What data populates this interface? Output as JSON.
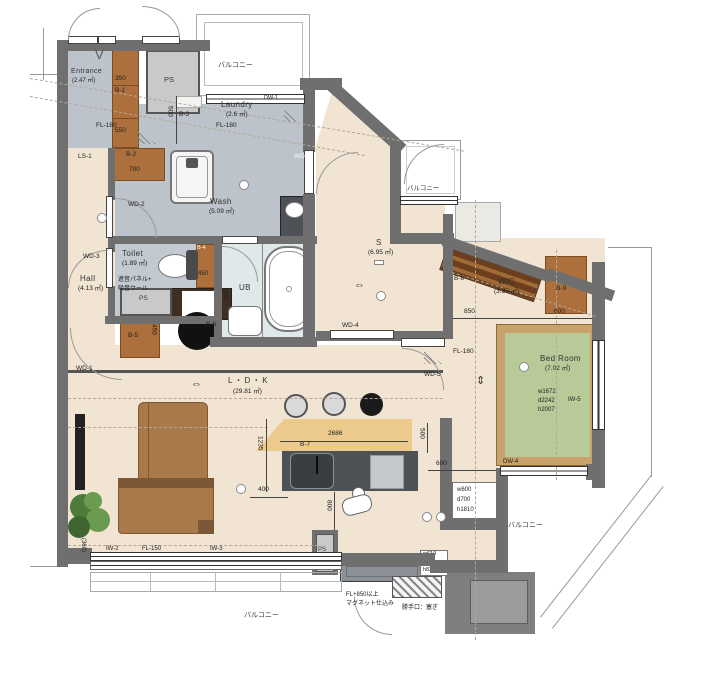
{
  "colors": {
    "wall": "#6f6f6f",
    "floor_wet": "#bcc3cb",
    "floor_main": "#f2e4d3",
    "floor_toilet": "#c2c9d0",
    "ub_floor": "#dfe9ea",
    "cabinet": "#ad6f3b",
    "cabinet_dark": "#6b3f1d",
    "bed_green": "#b7ca98",
    "bed_frame": "#c8a16b",
    "counter_wood": "#ecca8b",
    "kitchen_dark": "#4e5256",
    "sofa_brown": "#a9794a",
    "ps_gray": "#c9c9c9",
    "plant_green": "#4e7a3a"
  },
  "rooms": {
    "entrance": {
      "name": "Entrance",
      "area": "(2.47 ㎡)"
    },
    "laundry": {
      "name": "Laundry",
      "area": "(2.6 ㎡)"
    },
    "wash": {
      "name": "Wash",
      "area": "(5.09 ㎡)"
    },
    "toilet": {
      "name": "Toilet",
      "area": "(1.89 ㎡)",
      "note1": "遮音パネル+",
      "note2": "吸音ウール"
    },
    "hall": {
      "name": "Hall",
      "area": "(4.13 ㎡)"
    },
    "ub": {
      "name": "UB"
    },
    "s": {
      "name": "S",
      "area": "(6.95 ㎡)"
    },
    "wic": {
      "name": "WIC",
      "area": "(3.35 ㎡)"
    },
    "bedroom": {
      "name": "Bed Room",
      "area": "(7.02 ㎡)",
      "bed_w": "w1672",
      "bed_d": "d2242",
      "bed_h": "h2007"
    },
    "ldk": {
      "name": "L・D・K",
      "area": "(29.81 ㎡)"
    },
    "ps": "PS",
    "balcony": "バルコニー"
  },
  "storage": {
    "b1": "B-1",
    "b2": "B-2",
    "b3": "B-3",
    "b4": "B-4",
    "b5": "B-5",
    "b6": "B-6",
    "b7": "B-7",
    "b8": "B-8",
    "b9": "B-9",
    "ls1": "LS-1"
  },
  "openings": {
    "wd1": "WD-1",
    "wd2": "WD-2",
    "wd3": "WD-3",
    "wd4": "WD-4",
    "wd5": "WD-5",
    "wd6": "WD-6",
    "dw1": "DW-1",
    "dw4": "DW-4",
    "iw2": "IW-2",
    "iw3": "IW-3",
    "iw5": "IW-5"
  },
  "dims": {
    "d350": "350",
    "d550": "550",
    "d700": "700",
    "d500": "500",
    "d450": "450",
    "d850": "850",
    "d600": "600",
    "d2686": "2686",
    "d1235": "1235",
    "d800": "800",
    "d400": "400",
    "d360": "(360)"
  },
  "floor_levels": {
    "fl180": "FL-180",
    "fl150": "FL-150"
  },
  "notes": {
    "magnet1": "FL+850以上",
    "magnet2": "マグネット仕込み",
    "backdoor": "勝手口：塞ぎ",
    "fridge_w": "w600",
    "fridge_d": "d700",
    "fridge_h": "h1810",
    "cab_w": "w610",
    "cab_d": "d410",
    "cab_h": "h820",
    "v_mark": "V"
  },
  "symbols": {
    "arrow_h": "⇔",
    "arrow_v": "⇕"
  }
}
